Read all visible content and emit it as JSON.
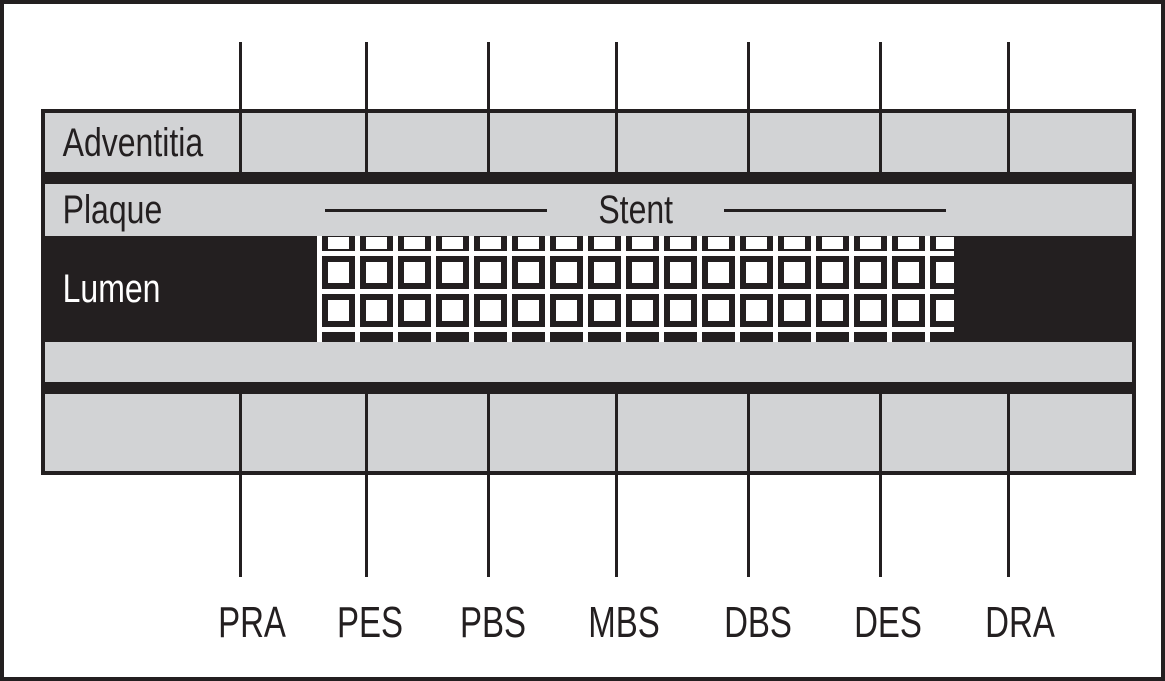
{
  "figure": {
    "layers": {
      "adventitia_label": "Adventitia",
      "plaque_label": "Plaque",
      "lumen_label": "Lumen"
    },
    "stent_label": "Stent",
    "markers": [
      {
        "label": "PRA",
        "line_x": 236,
        "label_x": 248
      },
      {
        "label": "PES",
        "line_x": 362,
        "label_x": 366
      },
      {
        "label": "PBS",
        "line_x": 484,
        "label_x": 489
      },
      {
        "label": "MBS",
        "line_x": 612,
        "label_x": 620
      },
      {
        "label": "DBS",
        "line_x": 744,
        "label_x": 754
      },
      {
        "label": "DES",
        "line_x": 876,
        "label_x": 884
      },
      {
        "label": "DRA",
        "line_x": 1004,
        "label_x": 1016
      }
    ],
    "mesh": {
      "columns": 17,
      "pitch": 38,
      "line_thickness": 4.5,
      "row_line_tops": [
        15,
        53,
        91
      ],
      "window_rows": [
        {
          "top": 1,
          "height": 12
        },
        {
          "top": 25.7,
          "height": 21
        },
        {
          "top": 63.7,
          "height": 21
        }
      ],
      "window_width": 21,
      "window_indent": 10.7
    },
    "colors": {
      "band_gray": "#d2d3d5",
      "ink": "#231f20",
      "stent_white": "#ffffff"
    }
  }
}
